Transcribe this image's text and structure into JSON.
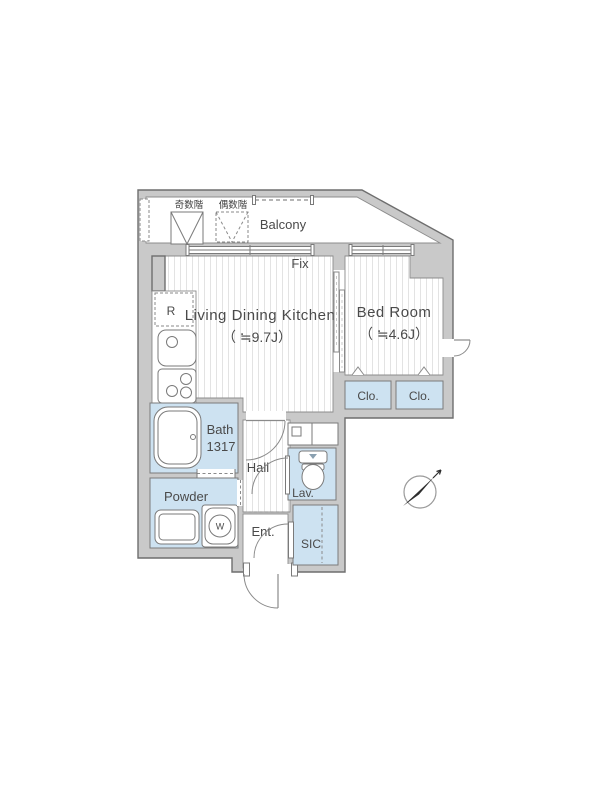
{
  "floorplan": {
    "balcony": {
      "label": "Balcony",
      "odd_floor_label": "奇数階",
      "even_floor_label": "偶数階"
    },
    "window_fix_label": "Fix",
    "ldk": {
      "name": "Living Dining Kitchen",
      "size": "（ ≒9.7J）"
    },
    "bedroom": {
      "name": "Bed Room",
      "size": "（ ≒4.6J）"
    },
    "closet_left": "Clo.",
    "closet_right": "Clo.",
    "bath": {
      "name": "Bath",
      "size": "1317"
    },
    "powder_room": {
      "line1": "Powder",
      "line2": "Room"
    },
    "hall_label": "Hall",
    "lavatory_label": "Lav.",
    "entrance_label": "Ent.",
    "sic_label": "SIC",
    "refrigerator_label": "R",
    "washer_label": "W",
    "colors": {
      "wall": "#c9c9c9",
      "wet_area": "#cde2f1",
      "outline": "#6e6e6e",
      "text": "#4a4a4a"
    }
  }
}
